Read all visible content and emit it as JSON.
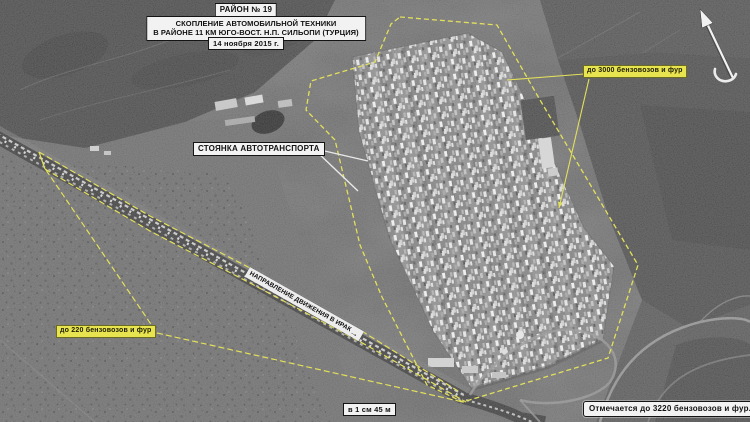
{
  "header": {
    "region_tag": "РАЙОН № 19",
    "title_line1": "СКОПЛЕНИЕ АВТОМОБИЛЬНОЙ ТЕХНИКИ",
    "title_line2": "В РАЙОНЕ 11 КМ ЮГО-ВОСТ. Н.П. СИЛЬОПИ (ТУРЦИЯ)",
    "date": "14 ноября 2015 г."
  },
  "callouts": {
    "parking": "СТОЯНКА АВТОТРАНСПОРТА",
    "count_northeast": "до 3000 бензовозов и фур",
    "count_southwest": "до 220 бензовозов и фур",
    "scale": "в 1 см 45 м",
    "total": "Отмечается до 3220 бензовозов и фур.",
    "road_direction": "НАПРАВЛЕНИЕ ДВИЖЕНИЯ В ИРАК",
    "road_direction_arrow": "→"
  },
  "colors": {
    "annotation_yellow": "#e3e05c",
    "yellow_label_bg": "#e8e44f",
    "label_white": "#f2f2f2",
    "label_text": "#111111"
  }
}
